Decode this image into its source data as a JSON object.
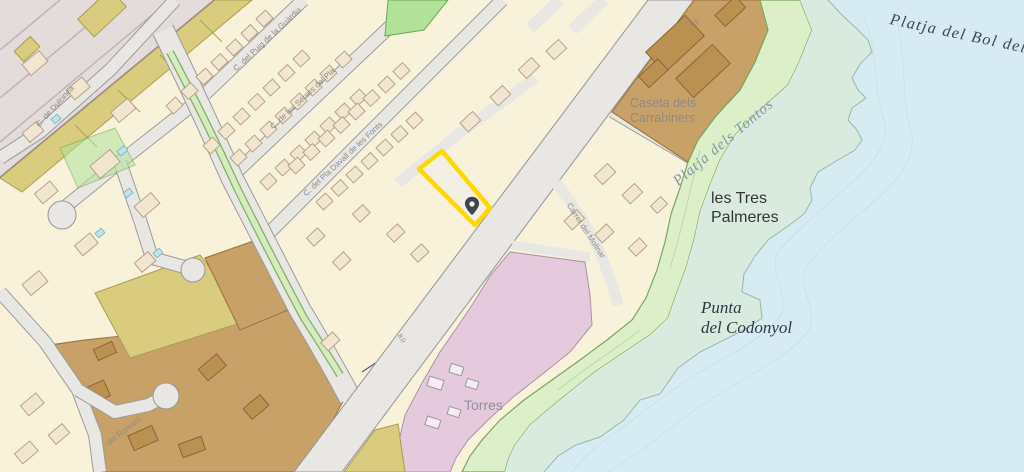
{
  "map": {
    "title": "coastal cadastral map",
    "place_labels": {
      "platja_bol": "Platja del Bol del Gos",
      "platja_tontos": "Platja dels Tontos",
      "tres_palmeres_line1": "les Tres",
      "tres_palmeres_line2": "Palmeres",
      "punta_line1": "Punta",
      "punta_line2": "del Codonyol",
      "caseta_line1": "Caseta dels",
      "caseta_line2": "Carrabiners",
      "torres": "Torres"
    },
    "street_labels": {
      "guardia": "C. del Puig de la Guàrdia",
      "senies": "C. de les Sénies del Pla",
      "pla_davall": "C. del Pla Davall de les Fonts",
      "dulcinea": "C. de Dulcinea",
      "romani": "del Romaní",
      "molinar": "Carrer del Molinar"
    },
    "annotations": {
      "width_1": "1,8",
      "width_2": "8,0"
    },
    "marker": {
      "type": "location-pin"
    },
    "colors": {
      "sea": "#d6ecf2",
      "shore": "#d9ebdf",
      "coast_green": "#dcefc8",
      "green_edge": "#79a65d",
      "park_green": "#b2e29a",
      "cream": "#f9f2da",
      "road": "#e9e7e3",
      "road_edge": "#9a9a9a",
      "brown": "#c8a168",
      "brown_dark": "#bb9152",
      "olive": "#d9cc7e",
      "pink": "#e5cade",
      "rail": "#e4dbdb",
      "rail_purple": "#8f7fae",
      "highlight": "#ffd800",
      "building": "#f3e6d0",
      "building_edge": "#b3a288",
      "pool": "#bfe4e8"
    }
  }
}
